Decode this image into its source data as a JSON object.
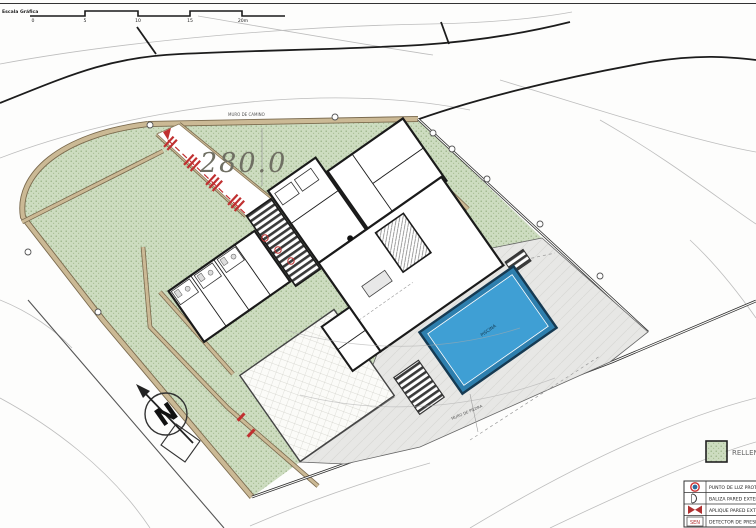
{
  "scale_bar": {
    "title": "Escala Gráfica",
    "ticks": [
      "0",
      "5",
      "10",
      "15",
      "20m"
    ]
  },
  "annotations": {
    "contour_elevation": "280.0",
    "north": "N",
    "top_wall": "MURO DE CAMINO",
    "lower_wall": "MURO DE PIEDRA",
    "pool": "PISCINA"
  },
  "legend": {
    "fill_label": "RELLEN",
    "items": [
      {
        "icon": "protected-light-point-icon",
        "label": "PUNTO DE LUZ PROTE"
      },
      {
        "icon": "exterior-wall-beacon-icon",
        "label": "BALIZA PARED EXTERI"
      },
      {
        "icon": "exterior-wall-sconce-icon",
        "label": "APLIQUE PARED EXTE"
      },
      {
        "icon": "presence-detector-icon",
        "icon_text": "SEN",
        "label": "DETECTOR DE PRESEN"
      }
    ]
  },
  "colors": {
    "garden_green": "#ccdcb8",
    "wall_tan": "#cbb995",
    "pool_blue": "#3f9fd4",
    "terrace_gray": "#e7e7e5",
    "marking_red": "#c03030"
  }
}
